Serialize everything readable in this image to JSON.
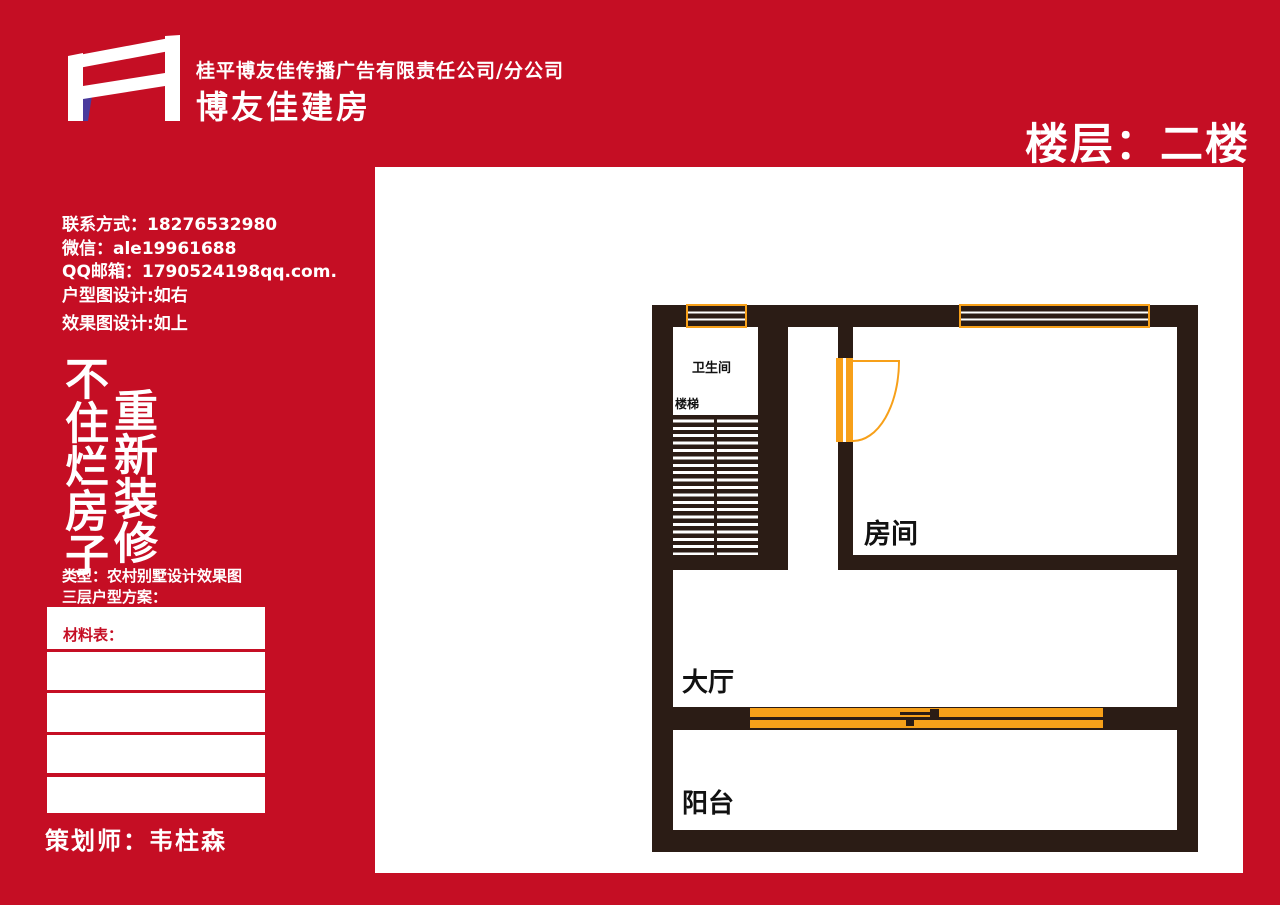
{
  "header": {
    "company_line": "桂平博友佳传播广告有限责任公司/分公司",
    "brand_name": "博友佳建房",
    "floor_label": "楼层：二楼"
  },
  "contact": {
    "phone": "联系方式：18276532980",
    "wechat": "微信：ale19961688",
    "qq": "QQ邮箱：1790524198qq.com.",
    "plan_note": "户型图设计:如右",
    "render_note": "效果图设计:如上"
  },
  "slogan": {
    "left_column": "不住烂房子",
    "right_column": "重新装修"
  },
  "project": {
    "type_line": "类型：农村别墅设计效果图",
    "scheme_line": "三层户型方案：",
    "material_table_label": "材料表：",
    "planner": "策划师：韦柱森"
  },
  "floorplan": {
    "labels": {
      "bathroom": "卫生间",
      "stairs": "楼梯",
      "room": "房间",
      "hall": "大厅",
      "balcony": "阳台"
    }
  },
  "colors": {
    "brand_red": "#C50E24",
    "wall_dark": "#2B1C15",
    "accent_orange": "#F7A019",
    "logo_purple": "#4A3A9C"
  }
}
